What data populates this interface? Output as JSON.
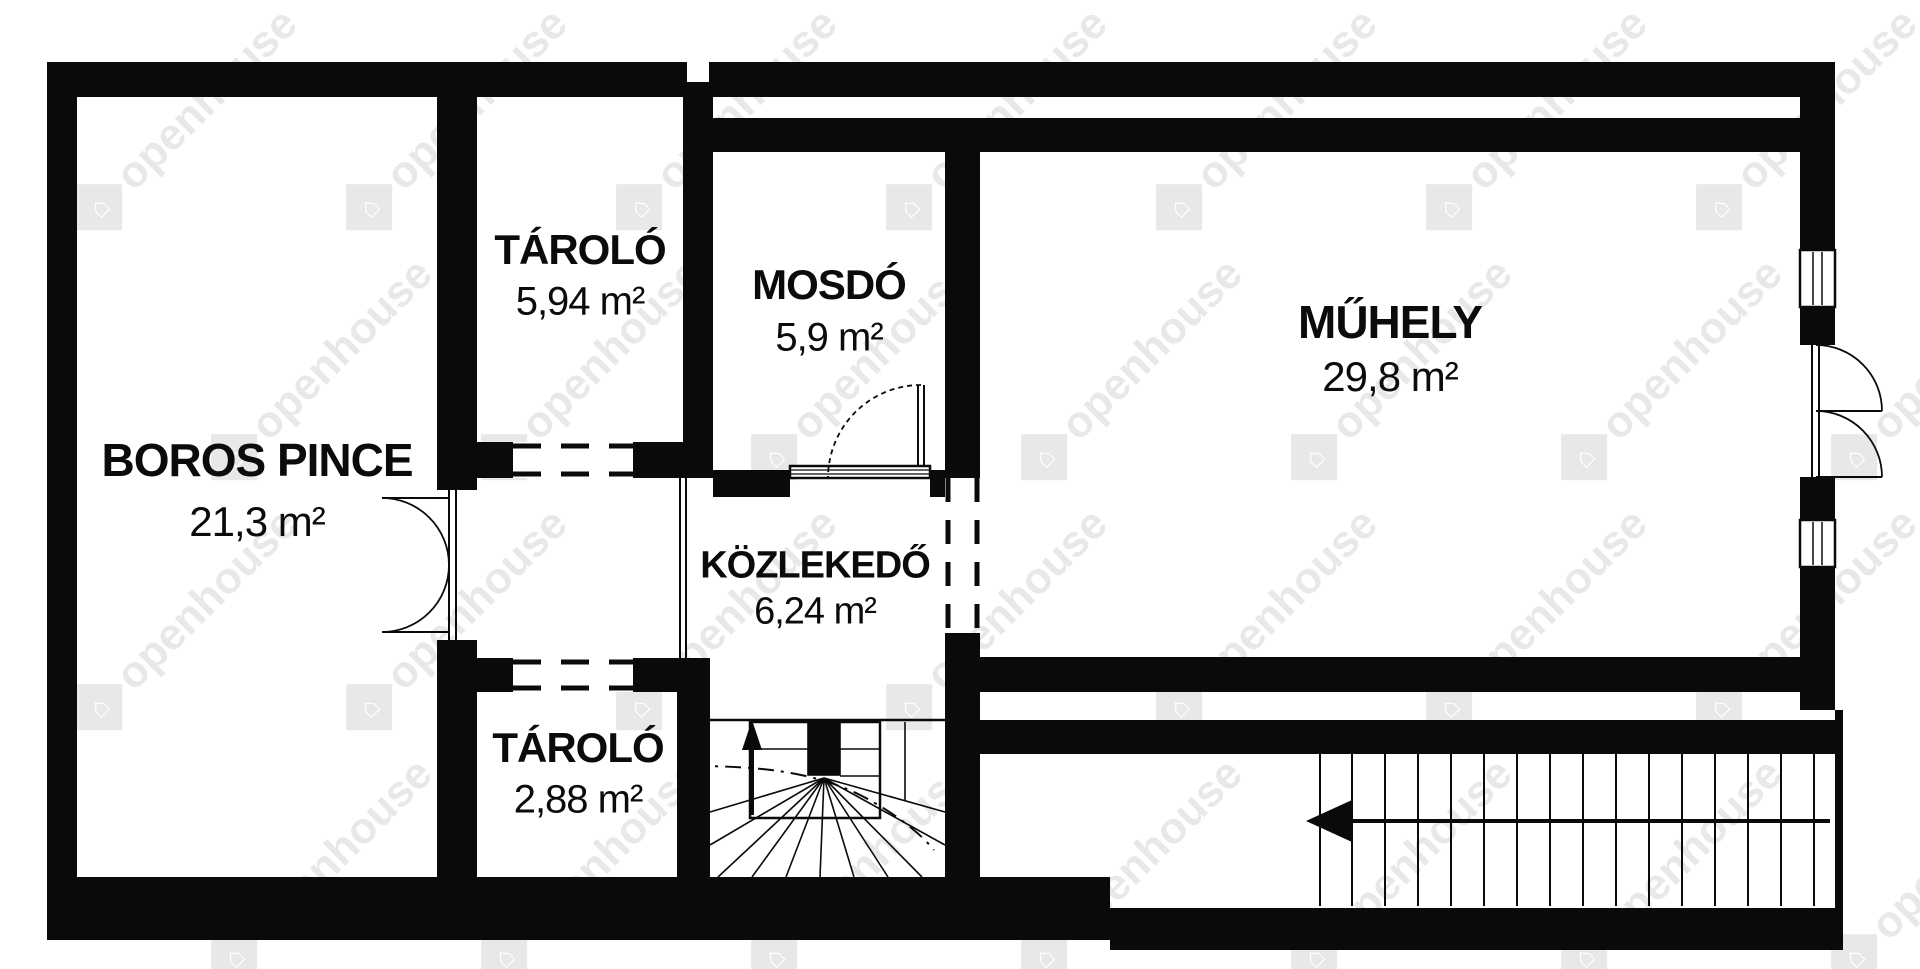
{
  "watermark": {
    "text": "openhouse",
    "logo_icon": "house-in-diamond-icon"
  },
  "colors": {
    "wall": "#0a0a0a",
    "background": "#ffffff",
    "text": "#0b0b0b",
    "watermark": "rgba(0,0,0,0.09)"
  },
  "rooms": [
    {
      "id": "boros-pince",
      "name": "BOROS PINCE",
      "area": "21,3 m²"
    },
    {
      "id": "tarolo-felso",
      "name": "TÁROLÓ",
      "area": "5,94 m²"
    },
    {
      "id": "mosdo",
      "name": "MOSDÓ",
      "area": "5,9 m²"
    },
    {
      "id": "muhely",
      "name": "MŰHELY",
      "area": "29,8 m²"
    },
    {
      "id": "kozlekedo",
      "name": "KÖZLEKEDŐ",
      "area": "6,24 m²"
    },
    {
      "id": "tarolo-also",
      "name": "TÁROLÓ",
      "area": "2,88 m²"
    }
  ],
  "symbols": {
    "winder_stairs_arrow": "up",
    "straight_stairs_arrow": "left"
  }
}
